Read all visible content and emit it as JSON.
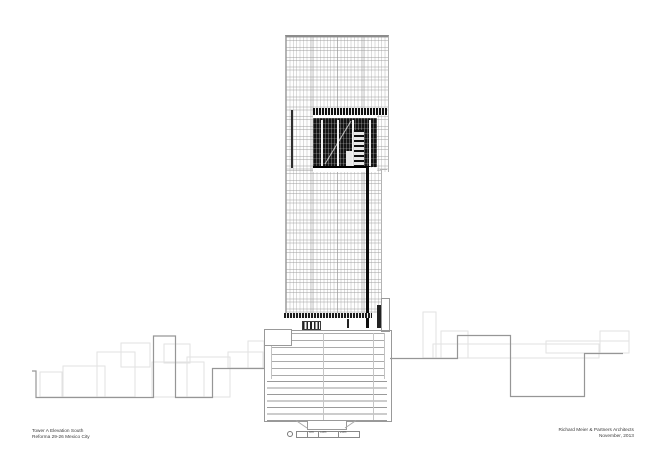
{
  "title_block": {
    "project_line1": "Tower A Elevation South",
    "project_line2": "Reforma 29-26 Mexico City",
    "firm": "Richard Meier & Partners Architects",
    "date": "November, 2013"
  },
  "scale_bar": {
    "labels": [
      "5m",
      "10m",
      "20m"
    ]
  },
  "colors": {
    "paper": "#ffffff",
    "context_line": "#969696",
    "faint_line": "#e2e2e2",
    "curtain_wall_grid": "#c8c8c8",
    "dark_fill": "#141414",
    "black": "#000000"
  }
}
